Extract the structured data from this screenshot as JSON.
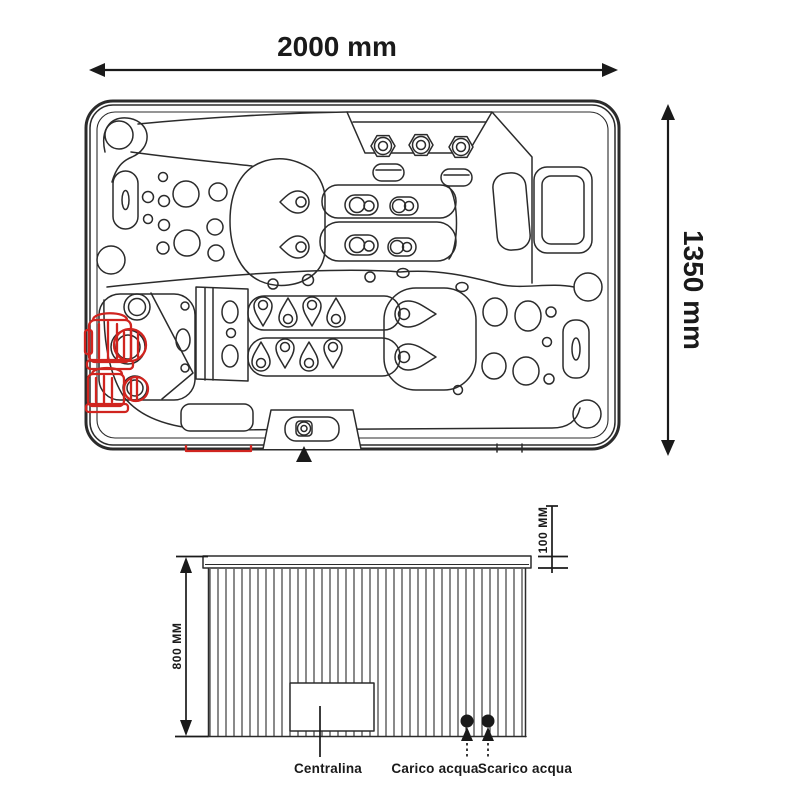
{
  "page": {
    "background": "#ffffff"
  },
  "colors": {
    "line": "#2b2b2b",
    "accent_red": "#d0241f",
    "ink": "#1a1a1a"
  },
  "top_view": {
    "width_label": "2000 mm",
    "height_label": "1350 mm"
  },
  "side_view": {
    "height_label": "800 MM",
    "lid_thickness_label": "100 MM",
    "control_unit_label": "Centralina",
    "water_inlet_label": "Carico acqua",
    "water_outlet_label": "Scarico acqua"
  }
}
